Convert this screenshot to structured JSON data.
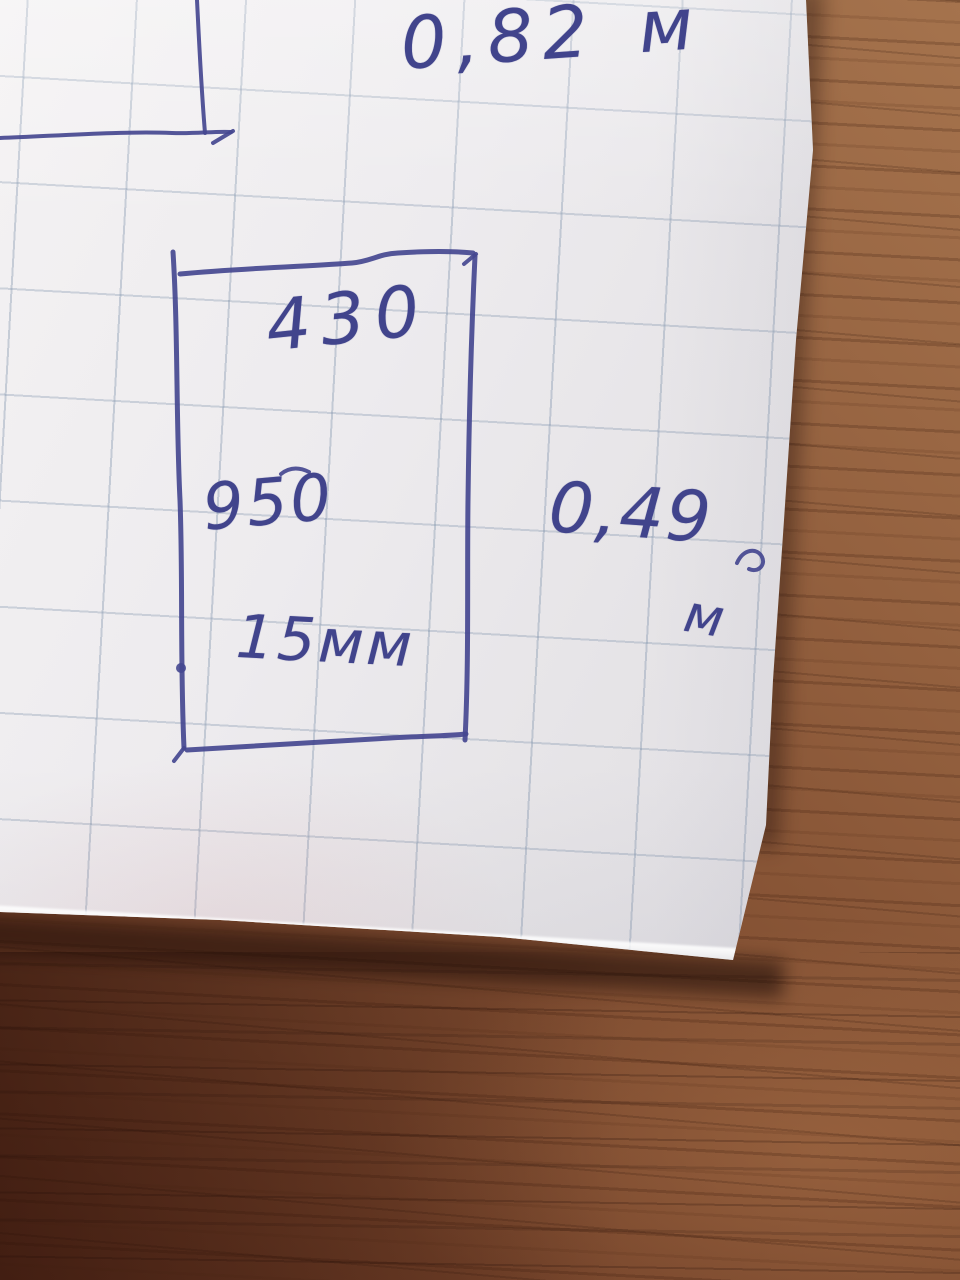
{
  "labels": {
    "top_width": "0,82 м",
    "box_width": "430",
    "box_height": "950",
    "box_thickness": "15мм",
    "right_height_value": "0,49",
    "right_height_unit": "м"
  },
  "colors": {
    "ink": "#454890",
    "paper": "#ebe9ec",
    "grid_line": "#7d91aa",
    "wood_light": "#a5734d",
    "wood_dark": "#5c2e1c"
  }
}
